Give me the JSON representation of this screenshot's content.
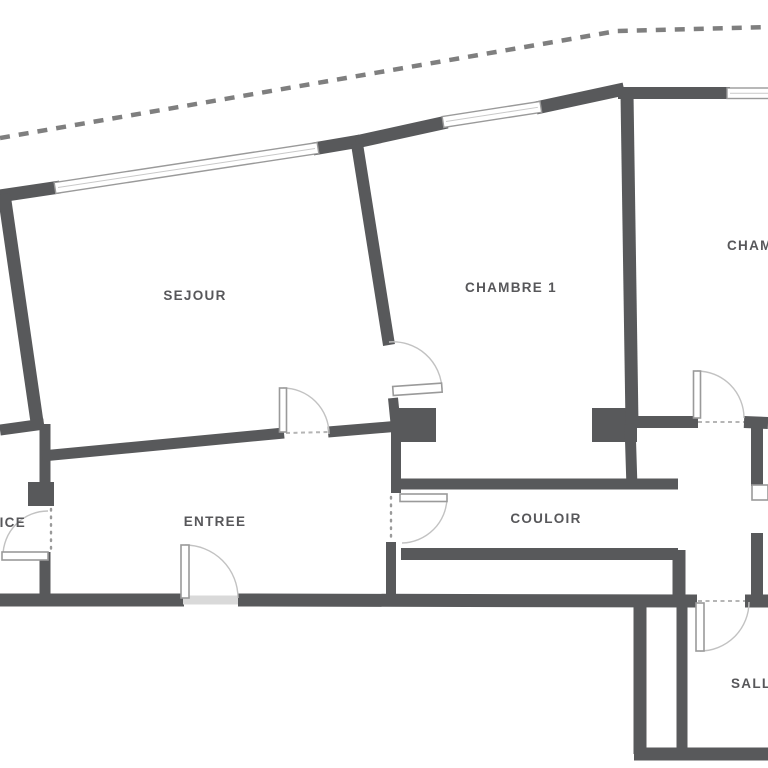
{
  "plan": {
    "type": "apartment-floor-plan",
    "rooms": {
      "sejour": {
        "label": "SEJOUR"
      },
      "chambre1": {
        "label": "CHAMBRE 1"
      },
      "chambre2": {
        "label": "CHAM",
        "note": "label cut off at right edge of image"
      },
      "entree": {
        "label": "ENTREE"
      },
      "couloir": {
        "label": "COULOIR"
      },
      "service": {
        "label": "ICE",
        "note": "label cut off at left edge of image"
      },
      "salle": {
        "label": "SALL",
        "note": "label cut off at right edge of image"
      }
    },
    "colors": {
      "wall": "#58595b",
      "label": "#57575a",
      "boundary_dash": "#7f7f7f",
      "door_arc": "#c2c2c2",
      "background": "#ffffff"
    },
    "symbols": {
      "window": "double-line white bar in exterior wall",
      "door": "white leaf with quarter-circle swing arc",
      "boundary": "dashed property/terrace line along top"
    }
  }
}
